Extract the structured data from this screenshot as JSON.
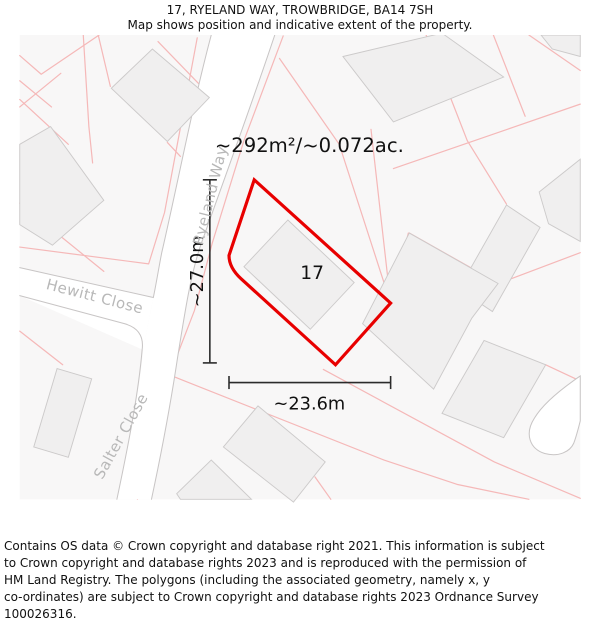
{
  "header": {
    "title": "17, RYELAND WAY, TROWBRIDGE, BA14 7SH",
    "subtitle": "Map shows position and indicative extent of the property."
  },
  "map": {
    "area_label": "~292m²/~0.072ac.",
    "plot_number": "17",
    "width_label": "~23.6m",
    "height_label": "~27.0m",
    "streets": {
      "ryeland_way": "Ryeland Way",
      "hewitt_close": "Hewitt Close",
      "salter_close": "Salter Close"
    },
    "colors": {
      "property_outline": "#e80000",
      "parcel_line": "#f5b8b8",
      "building_fill": "#f0efef",
      "building_stroke": "#cccaca",
      "road_fill": "#ffffff",
      "road_edge": "#c8c5c5",
      "map_background": "#f8f7f7",
      "street_label": "#b8b8b8",
      "dimension": "#2b2b2b"
    }
  },
  "footer": {
    "copyright": "Contains OS data © Crown copyright and database right 2021. This information is subject\nto Crown copyright and database rights 2023 and is reproduced with the permission of\nHM Land Registry. The polygons (including the associated geometry, namely x, y\nco-ordinates) are subject to Crown copyright and database rights 2023 Ordnance Survey\n100026316."
  }
}
